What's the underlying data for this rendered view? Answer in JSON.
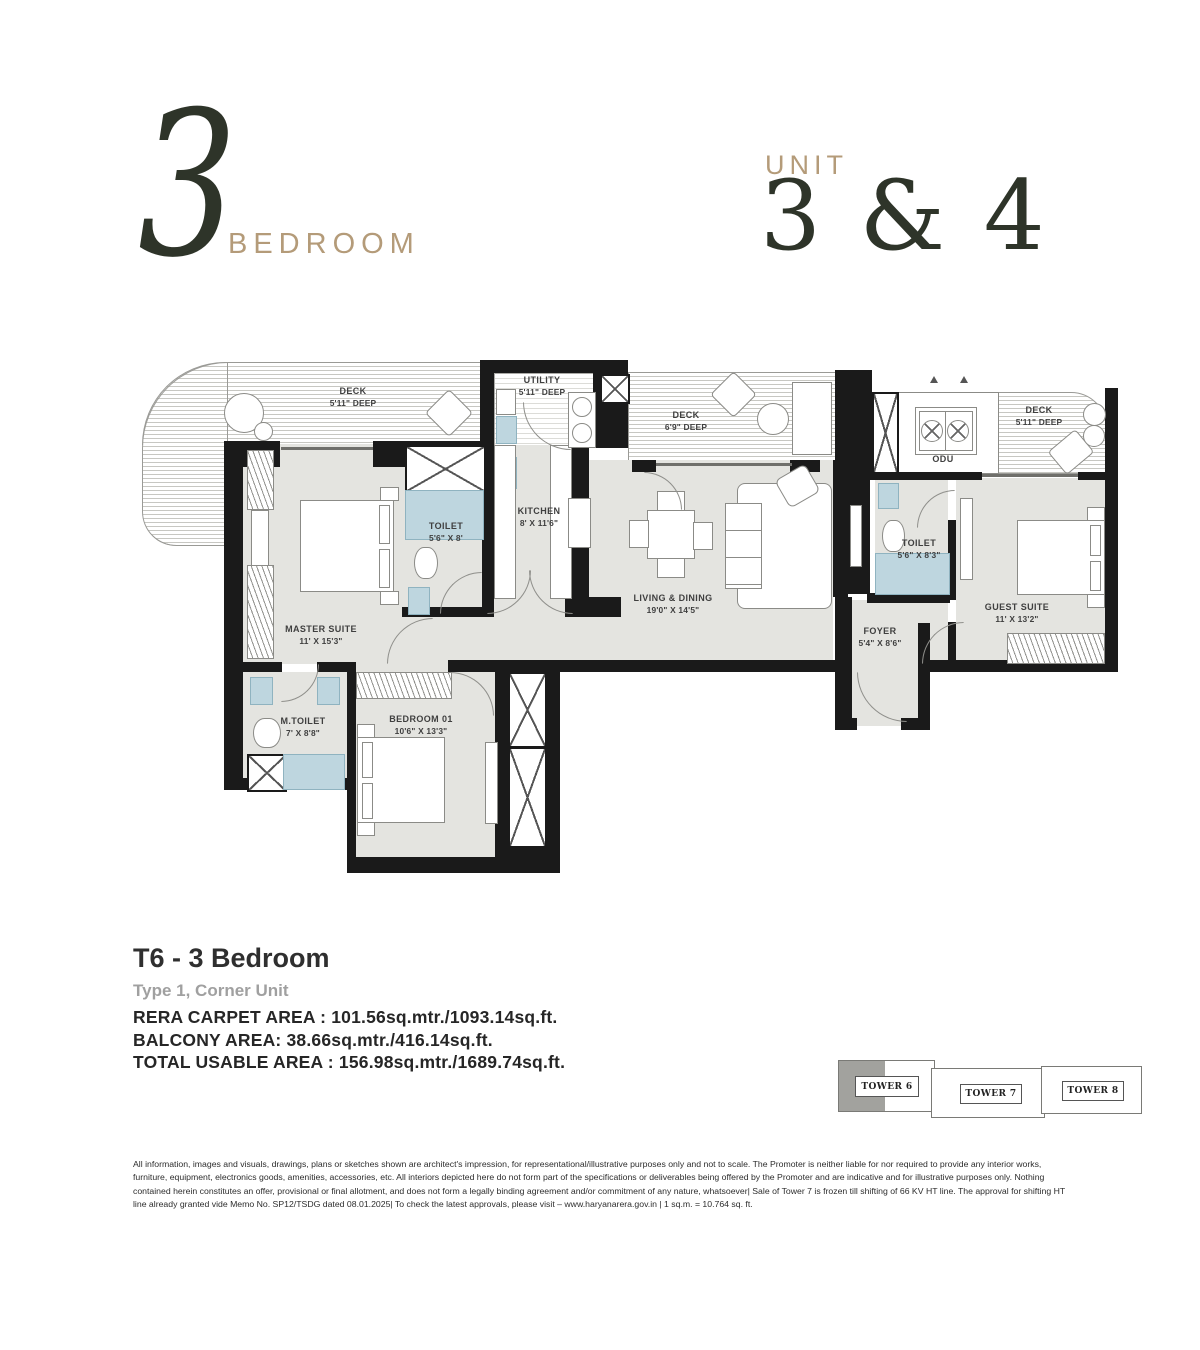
{
  "header": {
    "big_number": "3",
    "bedroom_label": "BEDROOM",
    "unit_label": "UNIT",
    "unit_numbers": "3 & 4"
  },
  "floorplan": {
    "rooms": {
      "deck_left": {
        "name": "DECK",
        "dims": "5'11\" DEEP"
      },
      "utility": {
        "name": "UTILITY",
        "dims": "5'11\" DEEP"
      },
      "deck_mid": {
        "name": "DECK",
        "dims": "6'9\" DEEP"
      },
      "deck_right": {
        "name": "DECK",
        "dims": "5'11\" DEEP"
      },
      "odu": {
        "name": "ODU",
        "dims": ""
      },
      "kitchen": {
        "name": "KITCHEN",
        "dims": "8' X 11'6\""
      },
      "toilet_1": {
        "name": "TOILET",
        "dims": "5'6\" X 8'"
      },
      "master_suite": {
        "name": "MASTER SUITE",
        "dims": "11' X 15'3\""
      },
      "living_dining": {
        "name": "LIVING & DINING",
        "dims": "19'0\" X 14'5\""
      },
      "toilet_2": {
        "name": "TOILET",
        "dims": "5'6\" X 8'3\""
      },
      "guest_suite": {
        "name": "GUEST SUITE",
        "dims": "11' X 13'2\""
      },
      "foyer": {
        "name": "FOYER",
        "dims": "5'4\" X 8'6\""
      },
      "m_toilet": {
        "name": "M.TOILET",
        "dims": "7' X 8'8\""
      },
      "bedroom_01": {
        "name": "BEDROOM 01",
        "dims": "10'6\" X 13'3\""
      }
    },
    "colors": {
      "wall": "#1a1a1a",
      "room": "#e4e4e0",
      "wet": "#bed6df",
      "accent": "#b49b79",
      "dark": "#2e3429"
    }
  },
  "details": {
    "title": "T6 - 3 Bedroom",
    "subtitle": "Type 1, Corner Unit",
    "area_lines": [
      "RERA CARPET AREA : 101.56sq.mtr./1093.14sq.ft.",
      "BALCONY AREA: 38.66sq.mtr./416.14sq.ft.",
      "TOTAL USABLE AREA : 156.98sq.mtr./1689.74sq.ft."
    ]
  },
  "tower_key": {
    "towers": [
      {
        "label": "TOWER 6"
      },
      {
        "label": "TOWER 7"
      },
      {
        "label": "TOWER 8"
      }
    ]
  },
  "disclaimer": "All information, images and visuals, drawings, plans or sketches shown are architect's impression, for representational/illustrative purposes only and not to scale. The Promoter is neither liable for nor required to provide any interior works, furniture, equipment, electronics goods, amenities, accessories, etc. All interiors depicted here do not form part of the specifications or deliverables being offered by the Promoter and are indicative and for illustrative purposes only. Nothing contained herein constitutes an offer, provisional or final allotment, and does not form a legally binding agreement and/or commitment of any nature, whatsoever| Sale of Tower 7 is frozen till shifting of 66 KV HT line. The approval for shifting HT line already granted vide Memo No. SP12/TSDG dated 08.01.2025| To check the latest approvals, please visit – www.haryanarera.gov.in | 1 sq.m. = 10.764 sq. ft."
}
